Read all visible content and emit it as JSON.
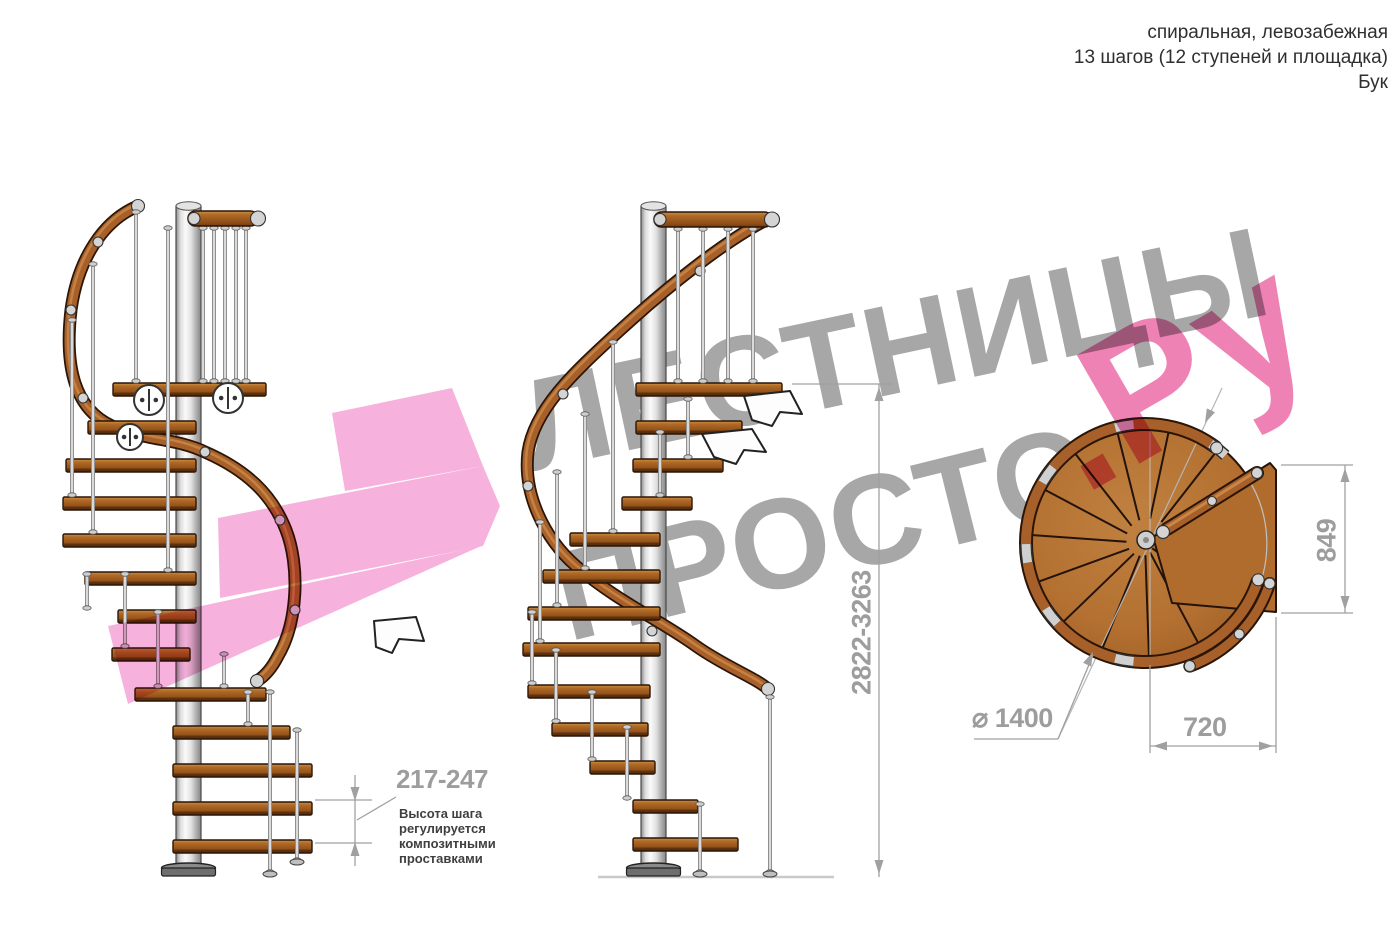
{
  "header": {
    "line1": "спиральная, левозабежная",
    "line2": "13 шагов (12 ступеней и площадка)",
    "line3": "Бук"
  },
  "watermark": {
    "word1": "ЛЕСТНИЦЫ",
    "word2": "ПРОСТО",
    "word3": ".Ру"
  },
  "dimensions": {
    "total_height": "2822-3263",
    "step_height": "217-247",
    "landing_height": "849",
    "landing_width": "720",
    "diameter": "⌀ 1400"
  },
  "note": {
    "line1": "Высота шага",
    "line2": "регулируется",
    "line3": "композитными",
    "line4": "проставками"
  },
  "colors": {
    "wood": "#a8602a",
    "wood_dark": "#6e3a10",
    "wood_light": "#c98747",
    "metal": "#d9d9d9",
    "pink_shape": "#f5aad8",
    "pink_text": "#ee74ad",
    "gray_watermark": "#a7a7a7",
    "dimension_gray": "#9d9d9d",
    "outline": "#2a1506"
  }
}
